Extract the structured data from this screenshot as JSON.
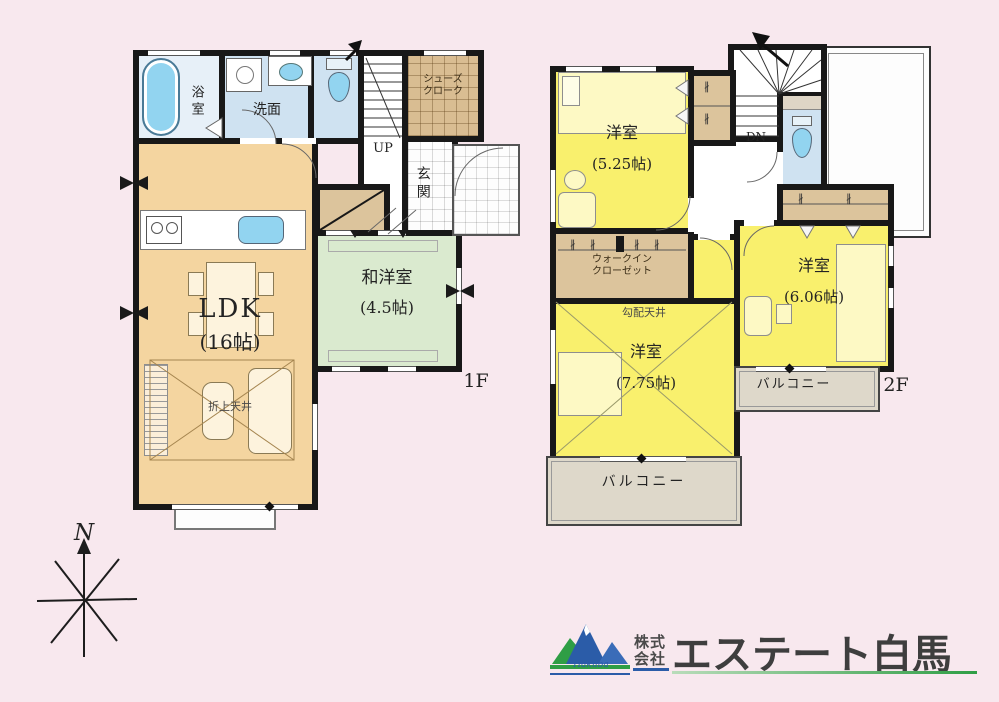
{
  "floor1": {
    "label": "1F",
    "ldk_name": "LDK",
    "ldk_size": "(16帖)",
    "washitsu_name": "和洋室",
    "washitsu_size": "(4.5帖)",
    "bath": "浴室",
    "washroom": "洗面",
    "entrance": "玄関",
    "shoe_closet_line1": "シューズ",
    "shoe_closet_line2": "クローク",
    "stairs_up": "UP",
    "ceiling_note": "折上天井"
  },
  "floor2": {
    "label": "2F",
    "room525_name": "洋室",
    "room525_size": "(5.25帖)",
    "room606_name": "洋室",
    "room606_size": "(6.06帖)",
    "room775_name": "洋室",
    "room775_size": "(7.75帖)",
    "wic_line1": "ウォークイン",
    "wic_line2": "クローゼット",
    "stairs_down": "DN",
    "ceiling_note": "勾配天井",
    "balcony_south": "バルコニー",
    "balcony_east": "バルコニー"
  },
  "compass": {
    "north_label": "N"
  },
  "symbols": {
    "hanger": "∦"
  },
  "logo": {
    "company_type_line1": "株式",
    "company_type_line2": "会社",
    "company_name": "エステート白馬",
    "mountain_script": "Hakuba"
  },
  "colors": {
    "background": "#f8e8ee",
    "wall": "#181818",
    "ldk_tan": "#f4d5a0",
    "room_yellow": "#f9f06d",
    "washitsu_green": "#daeacf",
    "wet_blue": "#cfe2f1",
    "bath_blue": "#e7f0f8",
    "fixture_blue": "#92d4f0",
    "closet_tan": "#dcc49c",
    "balcony_gray": "#ded8ca",
    "logo_green": "#2f9e45",
    "logo_blue": "#2b5ca8"
  }
}
